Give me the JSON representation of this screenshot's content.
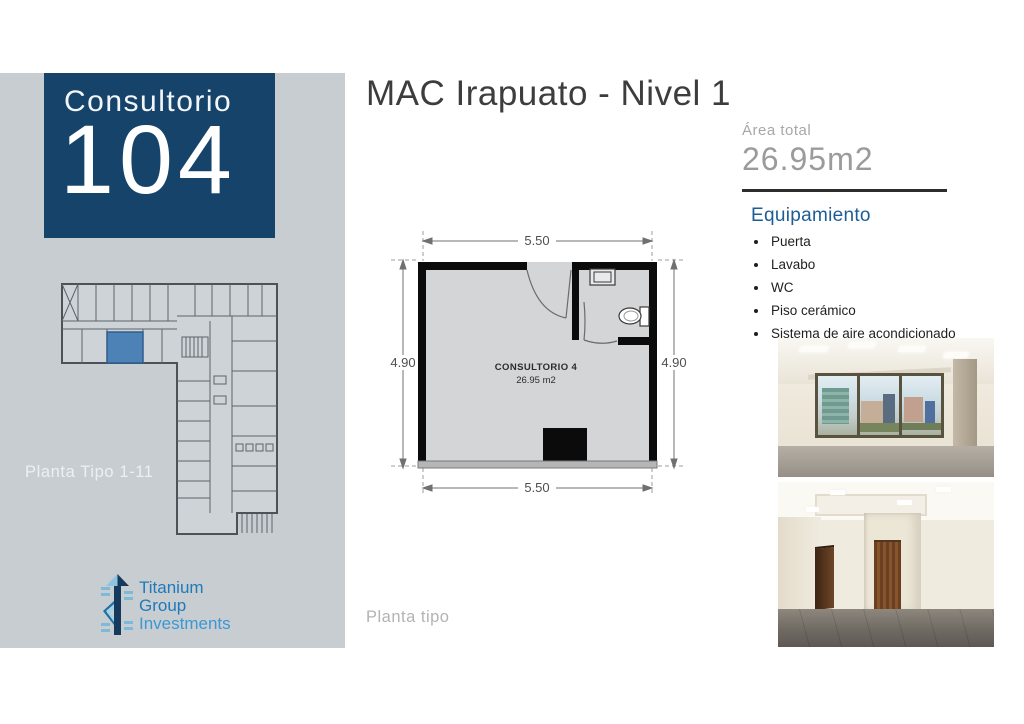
{
  "header": {
    "title": "MAC Irapuato - Nivel 1"
  },
  "sidebar": {
    "unit_label": "Consultorio",
    "unit_number": "104",
    "plan_caption": "Planta Tipo 1-11",
    "logo": {
      "line1": "Titanium",
      "line2": "Group",
      "line3": "Investments"
    }
  },
  "area": {
    "label": "Área total",
    "value": "26.95m2"
  },
  "equipment": {
    "heading": "Equipamiento",
    "items": [
      "Puerta",
      "Lavabo",
      "WC",
      "Piso cerámico",
      "Sistema de aire acondicionado"
    ]
  },
  "floorplan": {
    "room_name": "CONSULTORIO 4",
    "room_area": "26.95 m2",
    "dim_top": "5.50",
    "dim_bottom": "5.50",
    "dim_left": "4.90",
    "dim_right": "4.90",
    "caption": "Planta tipo"
  },
  "icons": {
    "toilet": "toilet-icon",
    "sink": "sink-icon",
    "logo_mark": "titanium-arrow-icon"
  },
  "colors": {
    "sidebar_bg": "#c8cdd2",
    "title_box": "#16436a",
    "highlight_room": "#4d82b6",
    "equipment_heading": "#1d5d95",
    "logo_blue": "#1f7ab8",
    "divider": "#2d2d2d",
    "dim_text": "#4e4f51"
  }
}
